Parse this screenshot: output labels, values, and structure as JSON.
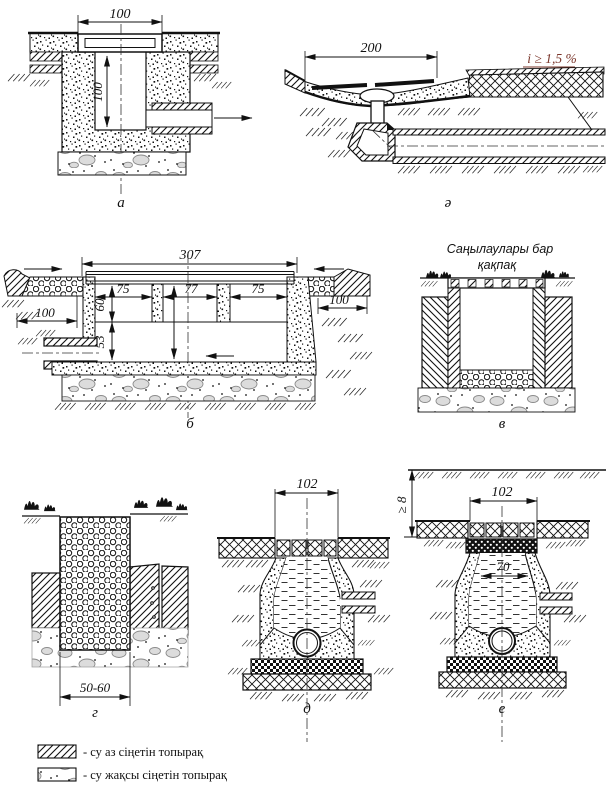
{
  "figure": {
    "a": {
      "letter": "а",
      "dim_width": "100",
      "dim_depth": "100"
    },
    "a2": {
      "letter": "ә",
      "dim_width": "200",
      "slope": "i ≥ 1,5 %"
    },
    "b": {
      "letter": "б",
      "dim_width": "307",
      "dim_left": "75",
      "dim_mid": "77",
      "dim_right": "75",
      "dim_h1": "60",
      "dim_h2": "53",
      "dim_100l": "100",
      "dim_100r": "100"
    },
    "v": {
      "letter": "в",
      "caption1": "Саңылаулары бар",
      "caption2": "қақпақ"
    },
    "g": {
      "letter": "г",
      "dim_width": "50-60"
    },
    "d": {
      "letter": "д",
      "dim_width": "102",
      "dim_depth": "≥ 8"
    },
    "e": {
      "letter": "е",
      "dim_width": "102",
      "dim_inner": "70"
    }
  },
  "legend": {
    "low_perm": "- су аз сіңетін топырақ",
    "high_perm": "- су жақсы сіңетін топырақ"
  }
}
